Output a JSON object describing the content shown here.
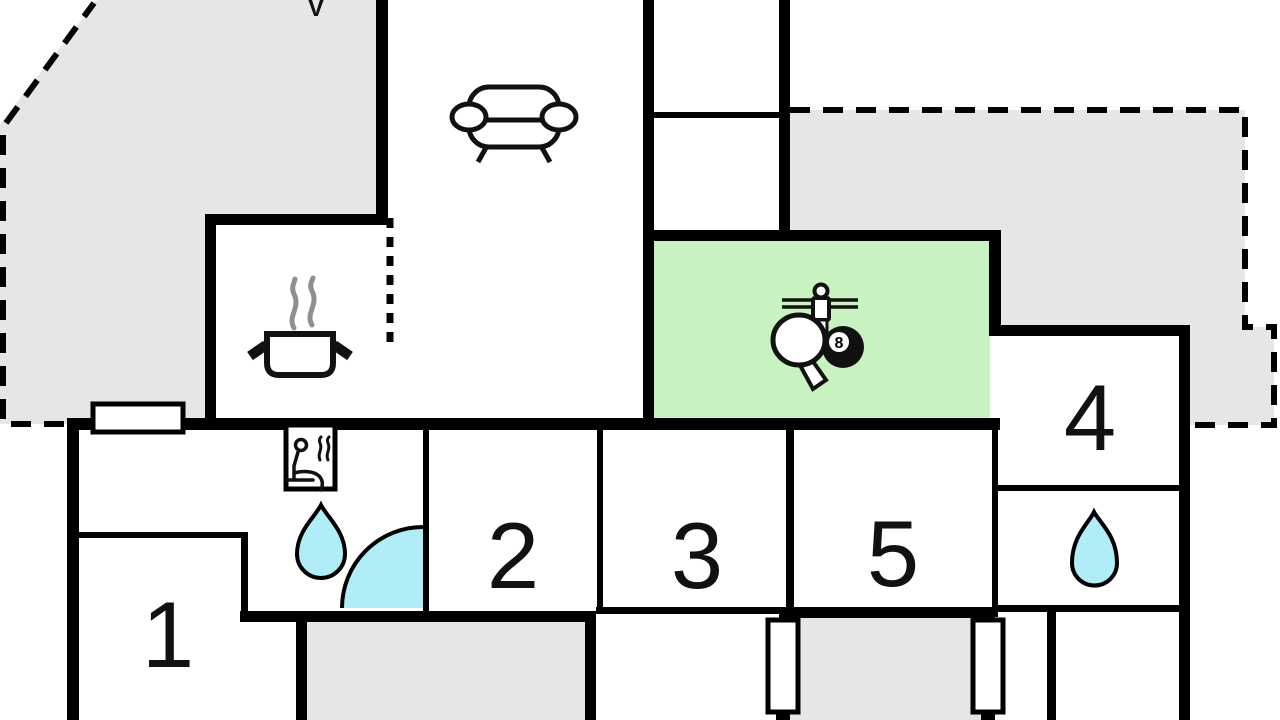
{
  "plan": {
    "north_mark": "V",
    "eight_ball_label": "8",
    "rooms": [
      {
        "number": "1"
      },
      {
        "number": "2"
      },
      {
        "number": "3"
      },
      {
        "number": "4"
      },
      {
        "number": "5"
      }
    ],
    "icons": {
      "living_area": "sofa-icon",
      "kitchen": "cooking-pot-icon",
      "game_room": [
        "table-tennis-paddle-icon",
        "foosball-player-icon",
        "eight-ball-icon"
      ],
      "sauna": "sauna-person-icon",
      "bathroom_main": "water-drop-icon",
      "bathroom_second": "water-drop-icon"
    },
    "colors": {
      "terrace_fill": "#e6e6e6",
      "game_room_fill": "#c8f3c0",
      "water_fill": "#b0edf6",
      "wall": "#000000",
      "steam": "#8f8f8f",
      "background": "#ffffff"
    }
  }
}
